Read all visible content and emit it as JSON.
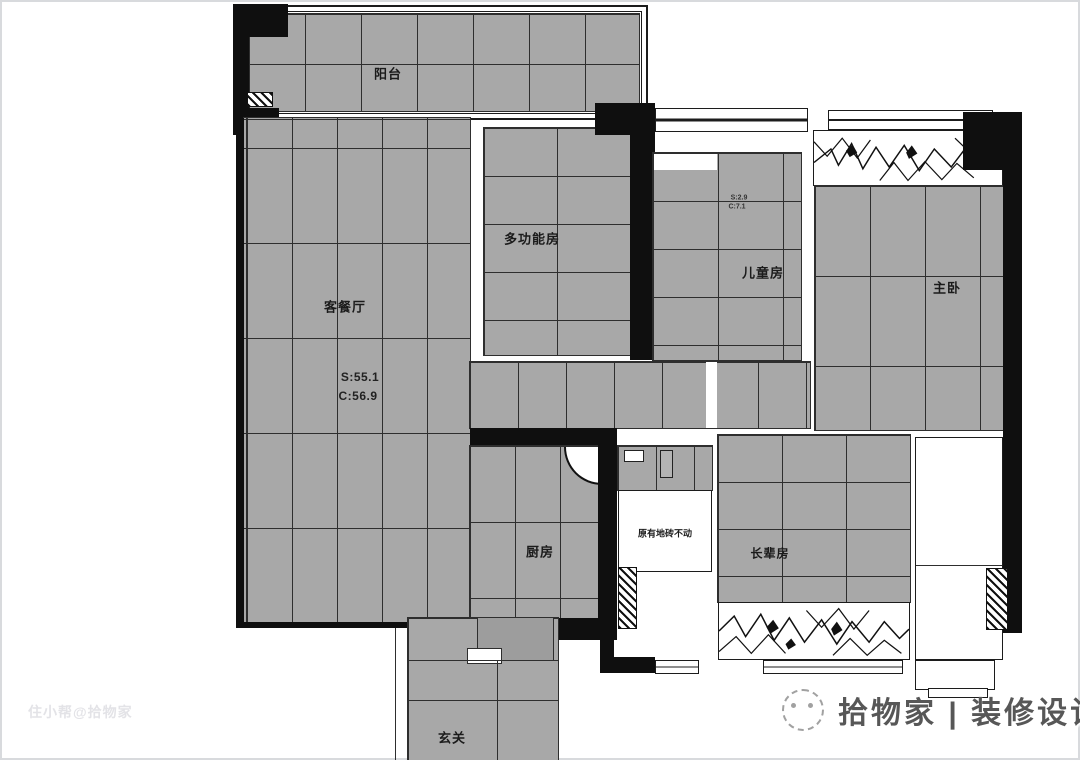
{
  "rooms": {
    "balcony": "阳台",
    "living_dining": "客餐厅",
    "multi_function": "多功能房",
    "kids": "儿童房",
    "master": "主卧",
    "kitchen": "厨房",
    "elders": "长辈房",
    "foyer": "玄关"
  },
  "annotations": {
    "living_area_s": "S:55.1",
    "living_area_c": "C:56.9",
    "kids_area_s": "S:2.9",
    "kids_area_c": "C:7.1",
    "bath_note": "原有地砖不动"
  },
  "watermarks": {
    "bottom_left": "住小帮@拾物家",
    "brand": "拾物家 | 装修设计"
  },
  "colors": {
    "tile_gray": "#a8a8a8",
    "grid_line": "#2e2e2e",
    "wall_black": "#0f0f0f",
    "background": "#ffffff"
  }
}
